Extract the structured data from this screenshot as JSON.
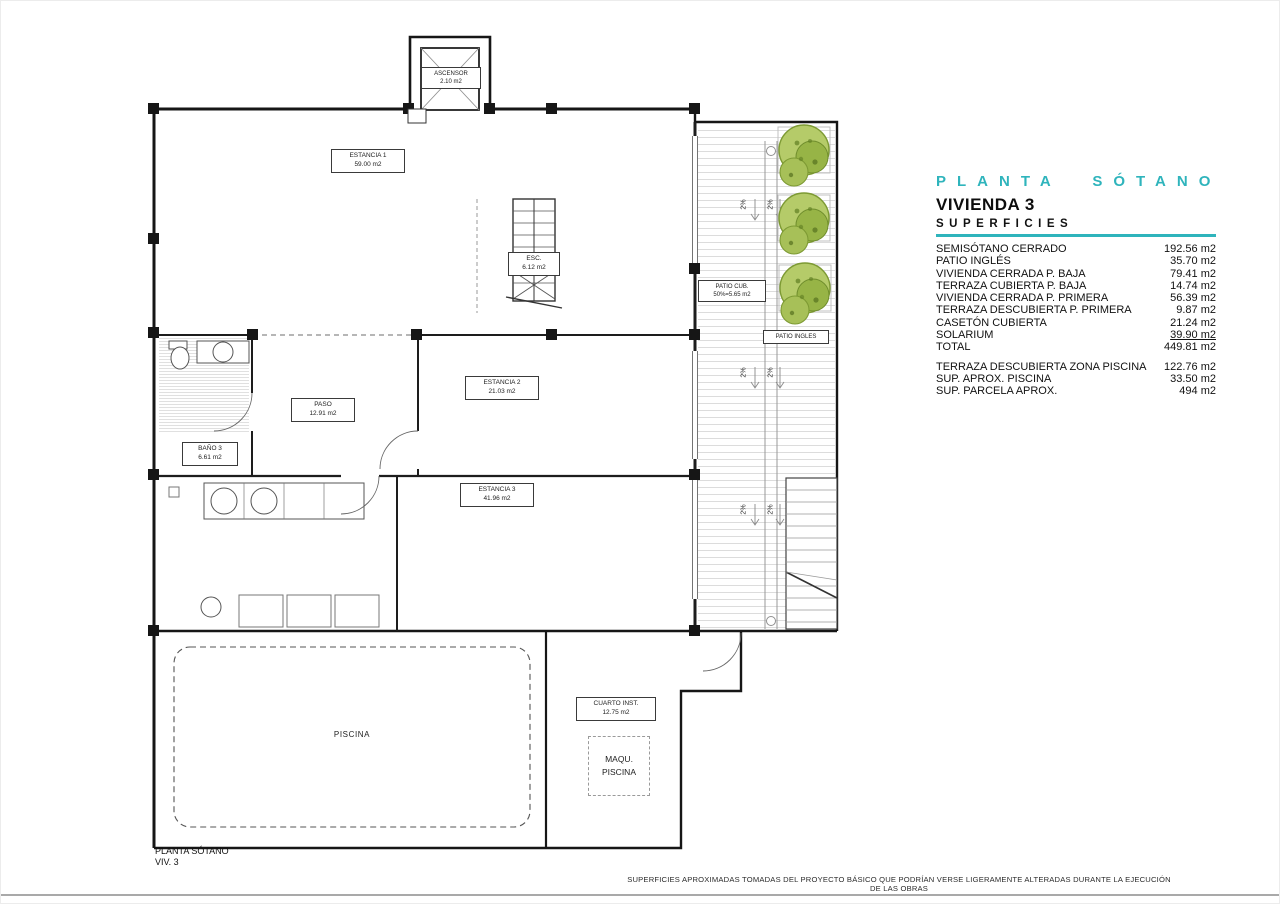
{
  "colors": {
    "accent": "#2fb4bc",
    "wall": "#161616",
    "tree_green": "#b5cb69",
    "tree_green_dark": "#6f8d2c",
    "hatch": "#dcdcdc"
  },
  "legend": {
    "title": "PLANTA SÓTANO",
    "subtitle": "VIVIENDA 3",
    "section": "SUPERFICIES",
    "rows": [
      {
        "label": "SEMISÓTANO CERRADO",
        "value": "192.56 m2"
      },
      {
        "label": "PATIO INGLÉS",
        "value": "35.70 m2"
      },
      {
        "label": "VIVIENDA CERRADA P. BAJA",
        "value": "79.41 m2"
      },
      {
        "label": "TERRAZA CUBIERTA P. BAJA",
        "value": "14.74 m2"
      },
      {
        "label": "VIVIENDA CERRADA P. PRIMERA",
        "value": "56.39 m2"
      },
      {
        "label": "TERRAZA DESCUBIERTA P. PRIMERA",
        "value": "9.87 m2"
      },
      {
        "label": "CASETÓN CUBIERTA",
        "value": "21.24 m2"
      },
      {
        "label": "SOLARIUM",
        "value": "39.90 m2"
      },
      {
        "label": "TOTAL",
        "value": "449.81 m2"
      }
    ],
    "extra_rows": [
      {
        "label": "TERRAZA DESCUBIERTA ZONA PISCINA",
        "value": "122.76 m2"
      },
      {
        "label": "SUP. APROX. PISCINA",
        "value": "33.50 m2"
      },
      {
        "label": "SUP. PARCELA APROX.",
        "value": "494 m2"
      }
    ]
  },
  "plan": {
    "slope_label": "2%",
    "rooms": [
      {
        "name": "ASCENSOR",
        "area": "2.10 m2"
      },
      {
        "name": "ESTANCIA 1",
        "area": "59.00 m2"
      },
      {
        "name": "ESC.",
        "area": "6.12 m2"
      },
      {
        "name": "PATIO CUB.",
        "area": "50%=5.65 m2"
      },
      {
        "name": "PATIO INGLES",
        "area": ""
      },
      {
        "name": "PASO",
        "area": "12.91 m2"
      },
      {
        "name": "ESTANCIA 2",
        "area": "21.03 m2"
      },
      {
        "name": "BAÑO 3",
        "area": "6.61 m2"
      },
      {
        "name": "ESTANCIA 3",
        "area": "41.96 m2"
      },
      {
        "name": "PISCINA",
        "area": ""
      },
      {
        "name": "CUARTO INST.",
        "area": "12.75 m2"
      },
      {
        "name": "MAQU.",
        "area": "PISCINA"
      }
    ],
    "caption": {
      "line1": "PLANTA SÓTANO",
      "line2": "VIV. 3"
    }
  },
  "footer": {
    "disclaimer": "SUPERFICIES APROXIMADAS TOMADAS DEL PROYECTO BÁSICO QUE PODRÍAN VERSE LIGERAMENTE ALTERADAS DURANTE LA EJECUCIÓN DE LAS OBRAS"
  }
}
